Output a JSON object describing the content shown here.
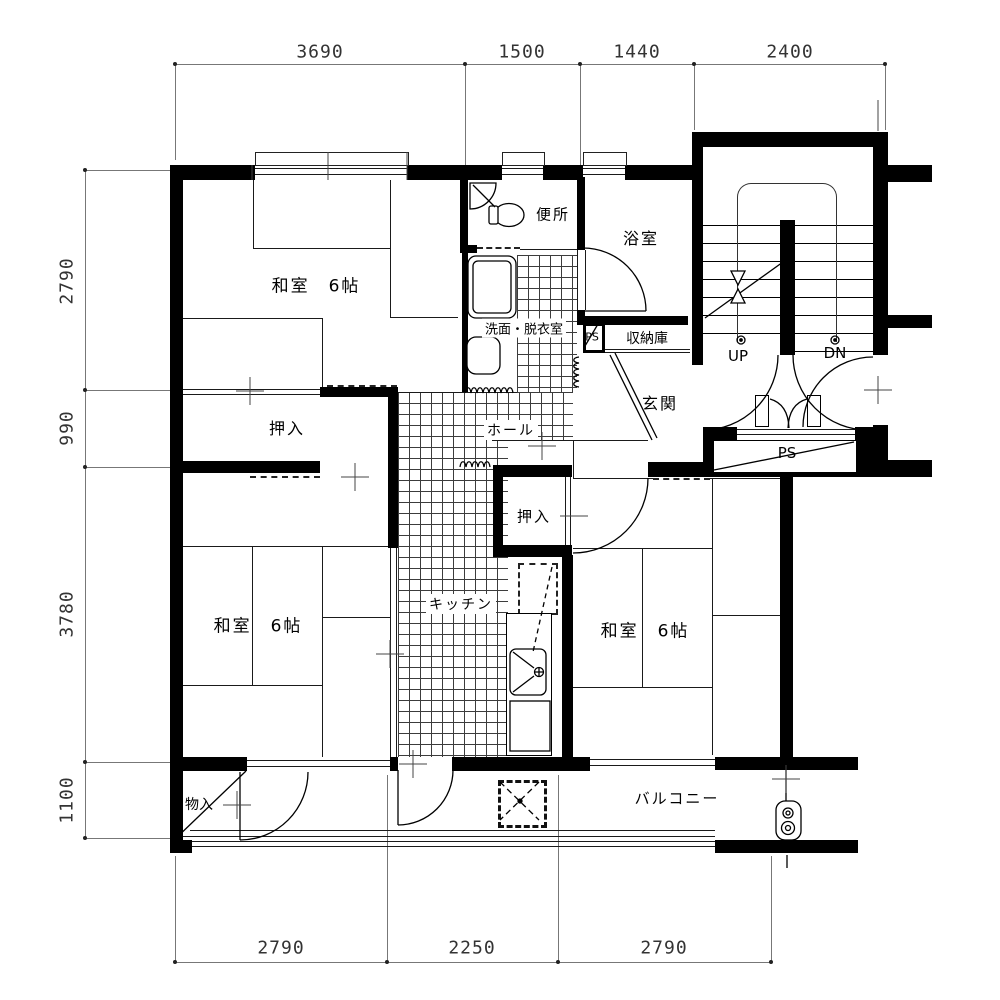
{
  "title": "間取り図 (apartment floor plan)",
  "rooms": {
    "washitsu_top": "和室　6帖",
    "washitsu_bottom_left": "和室　6帖",
    "washitsu_bottom_right": "和室　6帖",
    "oshiire_left": "押入",
    "oshiire_center": "押入",
    "benjo": "便所",
    "yokushitsu": "浴室",
    "senmen_datsuiishitsu": "洗面・脱衣室",
    "ps_small": "PS",
    "shunoko": "収納庫",
    "genkan": "玄関",
    "hall": "ホール",
    "kitchen": "キッチン",
    "stairs_up": "UP",
    "stairs_down": "DN",
    "ps_shaft": "PS",
    "mono_ire": "物入",
    "balcony": "バルコニー"
  },
  "dimensions": {
    "top": [
      "3690",
      "1500",
      "1440",
      "2400"
    ],
    "left": [
      "2790",
      "990",
      "3780",
      "1100"
    ],
    "bottom": [
      "2790",
      "2250",
      "2790"
    ]
  },
  "colors": {
    "wall": "#000000",
    "line": "#1a1a1a",
    "grid_line": "#3c3c3c",
    "dimension_text": "#333333",
    "background": "#ffffff"
  }
}
